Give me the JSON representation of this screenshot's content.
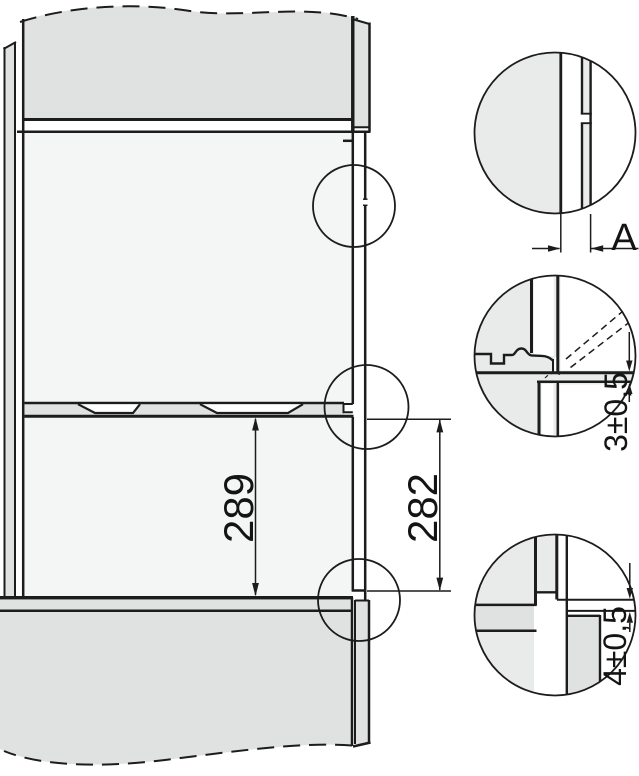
{
  "diagram": {
    "type": "technical-installation-drawing",
    "labels": {
      "niche_height": "289",
      "front_height": "282",
      "side_gap": "A",
      "top_gap": "3±0,5",
      "bottom_gap": "4±0,5"
    },
    "colors": {
      "line": "#1c1c1c",
      "panel_gray": "#e0e2e1",
      "niche_gray": "#f4f6f5",
      "detail_gray": "#e9ebea",
      "background": "#ffffff"
    }
  }
}
